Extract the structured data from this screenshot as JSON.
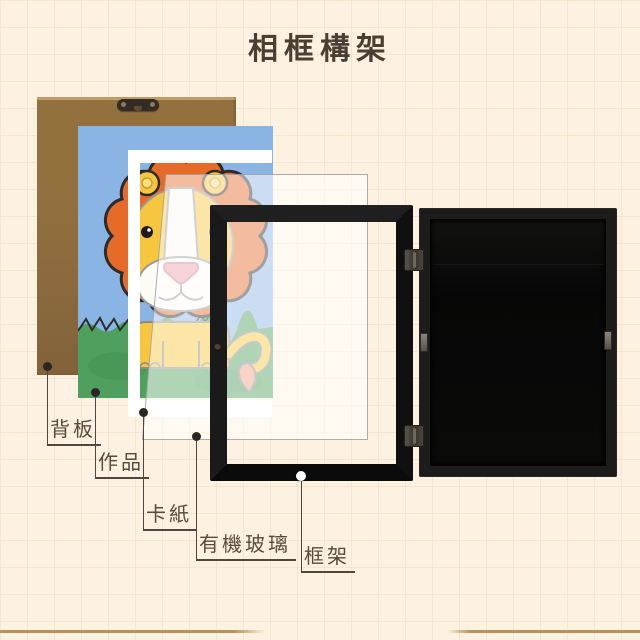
{
  "title": "相框構架",
  "callouts": [
    {
      "id": "backboard",
      "label": "背板"
    },
    {
      "id": "artwork",
      "label": "作品"
    },
    {
      "id": "mat",
      "label": "卡紙"
    },
    {
      "id": "acrylic",
      "label": "有機玻璃"
    },
    {
      "id": "frame",
      "label": "框架"
    }
  ],
  "colors": {
    "background": "#fdf2e1",
    "grid_line": "#e8d3b3",
    "title_text": "#4b3f33",
    "label_text": "#5a4a3c",
    "leader_line": "#4f463d",
    "backboard_brown": "#8d6a40",
    "mat_white": "#ffffff",
    "frame_black": "#161616",
    "artwork_sky_blue": "#8ab4e3",
    "artwork_grass_green": "#4f9f5e",
    "artwork_mane_orange": "#e76b28",
    "artwork_face_yellow": "#f6c73e",
    "accent_line_tan": "#b8935a"
  }
}
